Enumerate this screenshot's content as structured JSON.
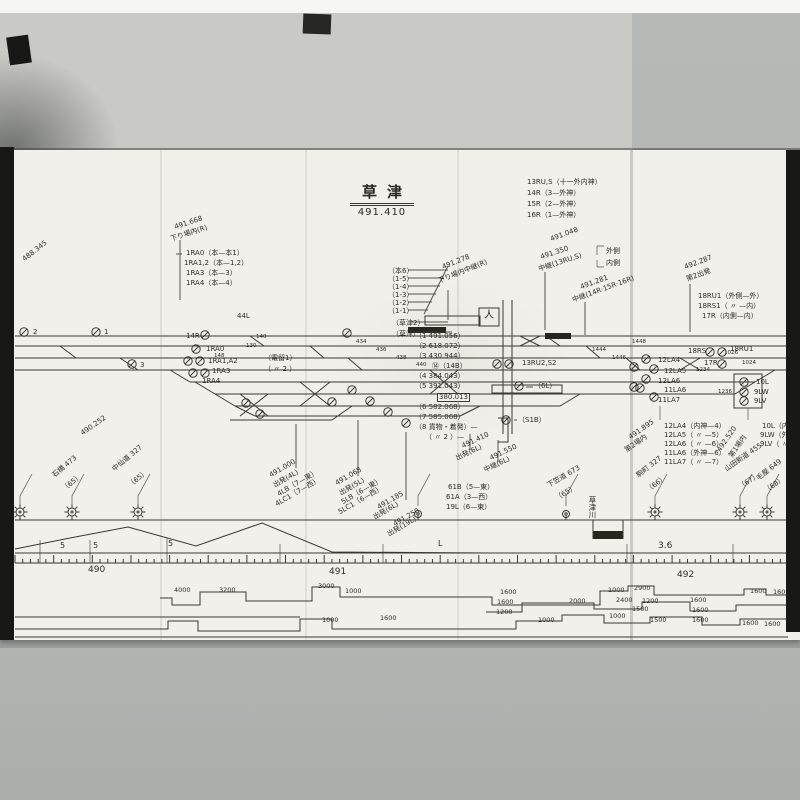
{
  "colors": {
    "paper": "#f1f0ea",
    "ink": "#3a3934",
    "photo_bg": "#b4b6b3",
    "fold_band": "#c9cac6",
    "edge_black": "#181816"
  },
  "station": {
    "name": "草津",
    "kilometer": "491.410"
  },
  "legend": {
    "lines": [
      "13RU,S（十一外内神）",
      "14R（3—外神）",
      "15R（2—外神）",
      "16R（1—外神）"
    ]
  },
  "labels": [
    {
      "t": "491.668",
      "x": 176,
      "y": 224,
      "r": -18
    },
    {
      "t": "下り場内(R)",
      "x": 172,
      "y": 236,
      "r": -18
    },
    {
      "t": "1RA0（本—本1）",
      "x": 186,
      "y": 250
    },
    {
      "t": "1RA1,2（本—1,2）",
      "x": 184,
      "y": 260
    },
    {
      "t": "1RA3（本—3）",
      "x": 186,
      "y": 270
    },
    {
      "t": "1RA4（本—4）",
      "x": 186,
      "y": 280
    },
    {
      "t": "488.345",
      "x": 26,
      "y": 256,
      "r": -38
    },
    {
      "t": "490.252",
      "x": 84,
      "y": 430,
      "r": -35
    },
    {
      "t": "（本6）",
      "x": 388,
      "y": 268
    },
    {
      "t": "（1-5）",
      "x": 388,
      "y": 276
    },
    {
      "t": "（1-4）",
      "x": 388,
      "y": 284
    },
    {
      "t": "（1-3）",
      "x": 388,
      "y": 292
    },
    {
      "t": "（1-2）",
      "x": 388,
      "y": 300
    },
    {
      "t": "（1-1）",
      "x": 388,
      "y": 308
    },
    {
      "t": "（草津2）",
      "x": 392,
      "y": 320
    },
    {
      "t": "（草津）",
      "x": 392,
      "y": 331
    },
    {
      "t": "44L",
      "x": 237,
      "y": 313
    },
    {
      "t": "14R",
      "x": 186,
      "y": 333
    },
    {
      "t": "491.278",
      "x": 444,
      "y": 264,
      "r": -22
    },
    {
      "t": "下り場内中継(R)",
      "x": 440,
      "y": 278,
      "r": -22
    },
    {
      "t": "491.048",
      "x": 552,
      "y": 236,
      "r": -20
    },
    {
      "t": "491.350",
      "x": 542,
      "y": 254,
      "r": -18
    },
    {
      "t": "中継(13RU,S)",
      "x": 540,
      "y": 266,
      "r": -18
    },
    {
      "t": "外側",
      "x": 606,
      "y": 248
    },
    {
      "t": "内側",
      "x": 606,
      "y": 260
    },
    {
      "t": "491.281",
      "x": 582,
      "y": 284,
      "r": -20
    },
    {
      "t": "中継(14R·15R·16R)",
      "x": 574,
      "y": 297,
      "r": -20
    },
    {
      "t": "492.287",
      "x": 686,
      "y": 264,
      "r": -20
    },
    {
      "t": "第2出発",
      "x": 688,
      "y": 276,
      "r": -20
    },
    {
      "t": "18RU1（外側—外）",
      "x": 698,
      "y": 293
    },
    {
      "t": "18RS1（ 〃 —内）",
      "x": 698,
      "y": 303
    },
    {
      "t": "17R（内側—内）",
      "x": 702,
      "y": 313
    },
    {
      "t": "（1 491.056）",
      "x": 415,
      "y": 333
    },
    {
      "t": "（2 618.072）",
      "x": 415,
      "y": 343
    },
    {
      "t": "（3 430.944）",
      "x": 415,
      "y": 353
    },
    {
      "t": "⑭（14B）",
      "x": 432,
      "y": 363
    },
    {
      "t": "（4 384.043）",
      "x": 415,
      "y": 373
    },
    {
      "t": "（5 391.043）",
      "x": 415,
      "y": 383
    },
    {
      "t": "380.013",
      "x": 437,
      "y": 393,
      "cls": "boxed"
    },
    {
      "t": "（6 582.068）",
      "x": 415,
      "y": 404
    },
    {
      "t": "（7 585.068）",
      "x": 415,
      "y": 414
    },
    {
      "t": "（8 貨物・着発）—",
      "x": 415,
      "y": 424
    },
    {
      "t": "（ 〃 2 ）—",
      "x": 425,
      "y": 434
    },
    {
      "t": "（電留1）",
      "x": 264,
      "y": 355
    },
    {
      "t": "（ 〃 2 ）",
      "x": 264,
      "y": 366
    },
    {
      "t": "1RA0",
      "x": 206,
      "y": 346
    },
    {
      "t": "1RA1,A2",
      "x": 208,
      "y": 358
    },
    {
      "t": "1RA3",
      "x": 212,
      "y": 368
    },
    {
      "t": "1RA4",
      "x": 202,
      "y": 378
    },
    {
      "t": "2",
      "x": 33,
      "y": 329
    },
    {
      "t": "1",
      "x": 104,
      "y": 329
    },
    {
      "t": "3",
      "x": 140,
      "y": 362
    },
    {
      "t": "13RU2,S2",
      "x": 522,
      "y": 360
    },
    {
      "t": "（6L）",
      "x": 534,
      "y": 383
    },
    {
      "t": "（S1B）",
      "x": 518,
      "y": 417
    },
    {
      "t": "18RS",
      "x": 688,
      "y": 348
    },
    {
      "t": "18RU1",
      "x": 730,
      "y": 346
    },
    {
      "t": "17R",
      "x": 704,
      "y": 360
    },
    {
      "t": "12LA4",
      "x": 658,
      "y": 357
    },
    {
      "t": "12LA5",
      "x": 664,
      "y": 368
    },
    {
      "t": "12LA6",
      "x": 658,
      "y": 378
    },
    {
      "t": "11LA6",
      "x": 664,
      "y": 387
    },
    {
      "t": "11LA7",
      "x": 658,
      "y": 397
    },
    {
      "t": "10L",
      "x": 756,
      "y": 379
    },
    {
      "t": "9LW",
      "x": 754,
      "y": 389
    },
    {
      "t": "9LV",
      "x": 754,
      "y": 398
    },
    {
      "t": "12LA4（内神—4）",
      "x": 664,
      "y": 423
    },
    {
      "t": "12LA5（ 〃 —5）",
      "x": 664,
      "y": 432
    },
    {
      "t": "12LA6（ 〃 —6）",
      "x": 664,
      "y": 441
    },
    {
      "t": "11LA6（外神—6）",
      "x": 664,
      "y": 450
    },
    {
      "t": "11LA7（ 〃 —7）",
      "x": 664,
      "y": 459
    },
    {
      "t": "10L（内神—）",
      "x": 762,
      "y": 423
    },
    {
      "t": "9LW（外神—）",
      "x": 760,
      "y": 432
    },
    {
      "t": "9LV（ 〃 —）",
      "x": 760,
      "y": 441
    },
    {
      "t": "491.895",
      "x": 632,
      "y": 434,
      "r": -35
    },
    {
      "t": "第2場内",
      "x": 628,
      "y": 447,
      "r": -35
    },
    {
      "t": "492.520",
      "x": 722,
      "y": 446,
      "r": -55
    },
    {
      "t": "第1場内",
      "x": 734,
      "y": 452,
      "r": -55
    },
    {
      "t": "491.410",
      "x": 464,
      "y": 443,
      "r": -25
    },
    {
      "t": "出発(6L)",
      "x": 458,
      "y": 455,
      "r": -25
    },
    {
      "t": "491.550",
      "x": 492,
      "y": 455,
      "r": -25
    },
    {
      "t": "中継(6L)",
      "x": 486,
      "y": 467,
      "r": -25
    },
    {
      "t": "61B（5—東）",
      "x": 448,
      "y": 484
    },
    {
      "t": "61A（3—西）",
      "x": 446,
      "y": 494
    },
    {
      "t": "19L（6—東）",
      "x": 446,
      "y": 504
    },
    {
      "t": "491.000",
      "x": 272,
      "y": 472,
      "r": -30
    },
    {
      "t": "出発(4L)",
      "x": 276,
      "y": 482,
      "r": -30
    },
    {
      "t": "4LB（7—東）",
      "x": 280,
      "y": 491,
      "r": -30
    },
    {
      "t": "4LC1（7—西）",
      "x": 278,
      "y": 501,
      "r": -30
    },
    {
      "t": "491.068",
      "x": 338,
      "y": 480,
      "r": -30
    },
    {
      "t": "出発(5L)",
      "x": 342,
      "y": 490,
      "r": -30
    },
    {
      "t": "5LB（6—東）",
      "x": 344,
      "y": 499,
      "r": -30
    },
    {
      "t": "5LC1（6—西）",
      "x": 341,
      "y": 509,
      "r": -30
    },
    {
      "t": "491.185",
      "x": 380,
      "y": 504,
      "r": -30
    },
    {
      "t": "出発(6L)",
      "x": 376,
      "y": 514,
      "r": -30
    },
    {
      "t": "491.250",
      "x": 396,
      "y": 521,
      "r": -30
    },
    {
      "t": "出発(19L)",
      "x": 390,
      "y": 531,
      "r": -30
    },
    {
      "t": "石橋 473",
      "x": 56,
      "y": 472,
      "r": -40
    },
    {
      "t": "（65）",
      "x": 66,
      "y": 486,
      "r": -40
    },
    {
      "t": "中仙道 327",
      "x": 116,
      "y": 466,
      "r": -40
    },
    {
      "t": "（65）",
      "x": 132,
      "y": 482,
      "r": -40
    },
    {
      "t": "下笠道 673",
      "x": 550,
      "y": 482,
      "r": -30
    },
    {
      "t": "（65）",
      "x": 558,
      "y": 495,
      "r": -30
    },
    {
      "t": "駒町 327",
      "x": 640,
      "y": 472,
      "r": -38
    },
    {
      "t": "（66）",
      "x": 650,
      "y": 487,
      "r": -38
    },
    {
      "t": "山田新道 455",
      "x": 728,
      "y": 466,
      "r": -35
    },
    {
      "t": "（67）",
      "x": 742,
      "y": 484,
      "r": -35
    },
    {
      "t": "毛屋 649",
      "x": 760,
      "y": 475,
      "r": -38
    },
    {
      "t": "（68）",
      "x": 768,
      "y": 488,
      "r": -38
    },
    {
      "t": "草津川",
      "x": 588,
      "y": 496,
      "v": true,
      "s": 7.5
    },
    {
      "t": "人",
      "x": 484,
      "y": 311,
      "s": 10,
      "n": "crossing-box-symbol"
    },
    {
      "t": "5",
      "x": 60,
      "y": 542,
      "s": 8
    },
    {
      "t": "5",
      "x": 93,
      "y": 542,
      "s": 8
    },
    {
      "t": "5",
      "x": 168,
      "y": 540,
      "s": 8
    },
    {
      "t": "L",
      "x": 438,
      "y": 540,
      "s": 8
    },
    {
      "t": "3.6",
      "x": 658,
      "y": 542,
      "s": 9
    },
    {
      "t": "490",
      "x": 88,
      "y": 566,
      "s": 9,
      "n": "milepost-490"
    },
    {
      "t": "491",
      "x": 329,
      "y": 568,
      "s": 9,
      "n": "milepost-491"
    },
    {
      "t": "492",
      "x": 677,
      "y": 571,
      "s": 9,
      "n": "milepost-492"
    },
    {
      "t": "4000",
      "x": 174,
      "y": 587,
      "s": 6.5
    },
    {
      "t": "3200",
      "x": 219,
      "y": 587,
      "s": 6.5
    },
    {
      "t": "3000",
      "x": 318,
      "y": 583,
      "s": 6.5
    },
    {
      "t": "1000",
      "x": 345,
      "y": 588,
      "s": 6.5
    },
    {
      "t": "1600",
      "x": 500,
      "y": 589,
      "s": 6.5
    },
    {
      "t": "1600",
      "x": 497,
      "y": 599,
      "s": 6.5
    },
    {
      "t": "1200",
      "x": 496,
      "y": 609,
      "s": 6.5
    },
    {
      "t": "1000",
      "x": 322,
      "y": 617,
      "s": 6.5
    },
    {
      "t": "1600",
      "x": 380,
      "y": 615,
      "s": 6.5
    },
    {
      "t": "1000",
      "x": 538,
      "y": 617,
      "s": 6.5
    },
    {
      "t": "2000",
      "x": 569,
      "y": 598,
      "s": 6.5
    },
    {
      "t": "1000",
      "x": 608,
      "y": 587,
      "s": 6.5
    },
    {
      "t": "2900",
      "x": 634,
      "y": 585,
      "s": 6.5
    },
    {
      "t": "2400",
      "x": 616,
      "y": 597,
      "s": 6.5
    },
    {
      "t": "1200",
      "x": 642,
      "y": 598,
      "s": 6.5
    },
    {
      "t": "1600",
      "x": 690,
      "y": 597,
      "s": 6.5
    },
    {
      "t": "1500",
      "x": 632,
      "y": 606,
      "s": 6.5
    },
    {
      "t": "1600",
      "x": 692,
      "y": 607,
      "s": 6.5
    },
    {
      "t": "1000",
      "x": 609,
      "y": 613,
      "s": 6.5
    },
    {
      "t": "1500",
      "x": 650,
      "y": 617,
      "s": 6.5
    },
    {
      "t": "1600",
      "x": 692,
      "y": 617,
      "s": 6.5
    },
    {
      "t": "1600",
      "x": 750,
      "y": 588,
      "s": 6.5
    },
    {
      "t": "1600",
      "x": 773,
      "y": 589,
      "s": 6.5
    },
    {
      "t": "1600",
      "x": 742,
      "y": 620,
      "s": 6.5
    },
    {
      "t": "1600",
      "x": 764,
      "y": 621,
      "s": 6.5
    },
    {
      "t": "130",
      "x": 246,
      "y": 344,
      "s": 5.5
    },
    {
      "t": "140",
      "x": 256,
      "y": 335,
      "s": 5.5
    },
    {
      "t": "148",
      "x": 214,
      "y": 354,
      "s": 5.5
    },
    {
      "t": "434",
      "x": 356,
      "y": 340,
      "s": 5.5
    },
    {
      "t": "436",
      "x": 376,
      "y": 348,
      "s": 5.5
    },
    {
      "t": "438",
      "x": 396,
      "y": 356,
      "s": 5.5
    },
    {
      "t": "440",
      "x": 416,
      "y": 363,
      "s": 5.5
    },
    {
      "t": "1444",
      "x": 592,
      "y": 348,
      "s": 5.5
    },
    {
      "t": "1446",
      "x": 612,
      "y": 356,
      "s": 5.5
    },
    {
      "t": "1448",
      "x": 632,
      "y": 340,
      "s": 5.5
    },
    {
      "t": "1024",
      "x": 742,
      "y": 361,
      "s": 5.5
    },
    {
      "t": "1026",
      "x": 724,
      "y": 351,
      "s": 5.5
    },
    {
      "t": "1234",
      "x": 696,
      "y": 368,
      "s": 5.5
    },
    {
      "t": "1236",
      "x": 718,
      "y": 390,
      "s": 5.5
    }
  ],
  "signals": [
    {
      "x": 24,
      "y": 332
    },
    {
      "x": 96,
      "y": 332
    },
    {
      "x": 132,
      "y": 364
    },
    {
      "x": 196,
      "y": 349
    },
    {
      "x": 188,
      "y": 361
    },
    {
      "x": 200,
      "y": 361
    },
    {
      "x": 193,
      "y": 373
    },
    {
      "x": 205,
      "y": 373
    },
    {
      "x": 205,
      "y": 335
    },
    {
      "x": 347,
      "y": 333
    },
    {
      "x": 352,
      "y": 390
    },
    {
      "x": 370,
      "y": 401
    },
    {
      "x": 388,
      "y": 412
    },
    {
      "x": 406,
      "y": 423
    },
    {
      "x": 332,
      "y": 402
    },
    {
      "x": 246,
      "y": 403
    },
    {
      "x": 260,
      "y": 414
    },
    {
      "x": 497,
      "y": 364
    },
    {
      "x": 509,
      "y": 364
    },
    {
      "x": 519,
      "y": 386
    },
    {
      "x": 506,
      "y": 420
    },
    {
      "x": 646,
      "y": 359
    },
    {
      "x": 654,
      "y": 369
    },
    {
      "x": 646,
      "y": 379
    },
    {
      "x": 640,
      "y": 388
    },
    {
      "x": 654,
      "y": 397
    },
    {
      "x": 634,
      "y": 367
    },
    {
      "x": 634,
      "y": 387
    },
    {
      "x": 710,
      "y": 352
    },
    {
      "x": 722,
      "y": 352
    },
    {
      "x": 722,
      "y": 364
    },
    {
      "x": 744,
      "y": 382
    },
    {
      "x": 744,
      "y": 392
    },
    {
      "x": 744,
      "y": 401
    }
  ],
  "poles": [
    {
      "x": 20,
      "ty": "star"
    },
    {
      "x": 72,
      "ty": "star"
    },
    {
      "x": 138,
      "ty": "star"
    },
    {
      "x": 418,
      "ty": "dot"
    },
    {
      "x": 566,
      "ty": "dot"
    },
    {
      "x": 655,
      "ty": "star"
    },
    {
      "x": 740,
      "ty": "star"
    },
    {
      "x": 767,
      "ty": "star"
    }
  ]
}
